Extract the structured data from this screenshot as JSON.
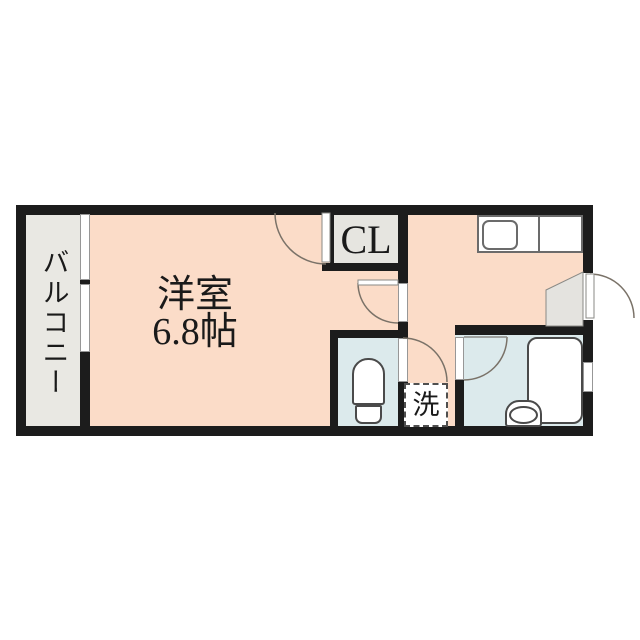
{
  "plan": {
    "title": "1K apartment floor plan",
    "rooms": {
      "balcony": {
        "label": "バルコニー"
      },
      "main_room": {
        "label": "洋室",
        "size_label": "6.8帖"
      },
      "closet": {
        "label": "CL"
      },
      "washer": {
        "label": "洗"
      }
    },
    "colors": {
      "wall": "#1c1c1c",
      "room_fill": "#fbdcc8",
      "balcony_fill": "#e9e8e3",
      "wet_area_fill": "#dceaec",
      "closet_fill": "#e6e5e0",
      "genkan_fill": "#e4e3df",
      "fixture_line": "#555555",
      "swing_line": "#7a7268",
      "background": "#ffffff"
    }
  }
}
